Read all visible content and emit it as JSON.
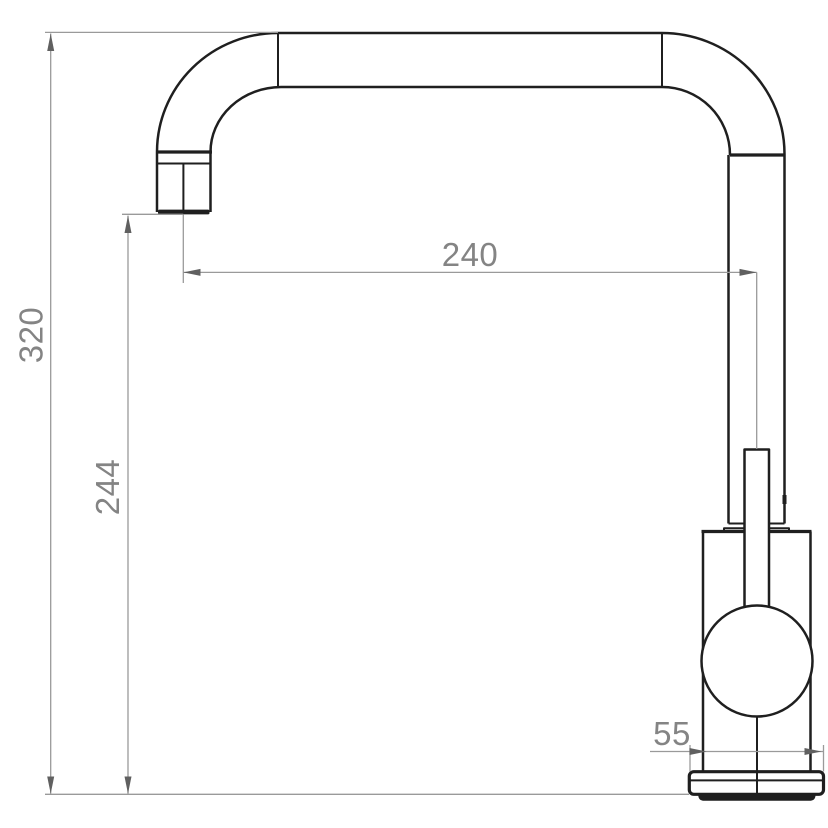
{
  "diagram": {
    "type": "technical-dimension-drawing",
    "subject": "kitchen-mixer-tap-side-elevation",
    "dimensions": [
      {
        "id": "overall-height",
        "value": "320",
        "orientation": "vertical"
      },
      {
        "id": "spout-outlet-height",
        "value": "244",
        "orientation": "vertical"
      },
      {
        "id": "spout-reach",
        "value": "240",
        "orientation": "horizontal"
      },
      {
        "id": "base-width",
        "value": "55",
        "orientation": "horizontal"
      }
    ],
    "colors": {
      "outline": "#1f1f1f",
      "dimension_line": "#9a9a9a",
      "arrow": "#606060",
      "dimension_text": "#848484",
      "background": "#ffffff"
    }
  }
}
